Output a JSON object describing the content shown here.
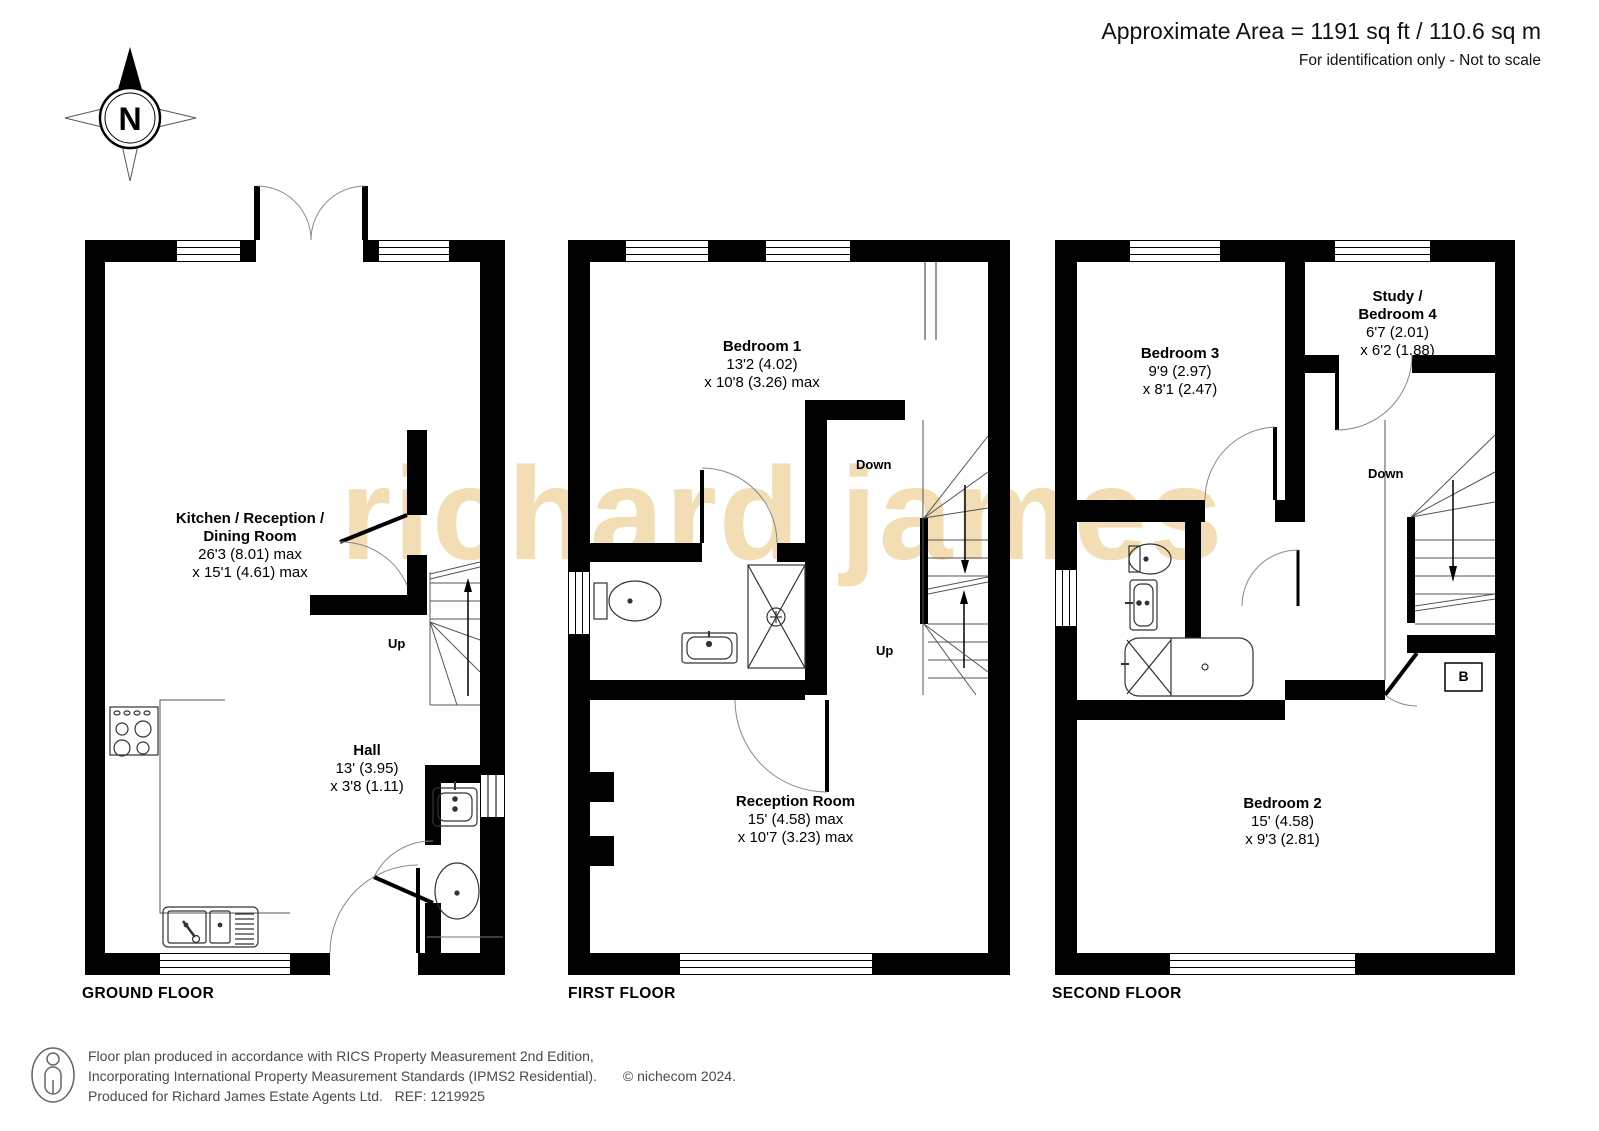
{
  "header": {
    "area": "Approximate Area = 1191 sq ft / 110.6 sq m",
    "disclaimer": "For identification only - Not to scale"
  },
  "compass": {
    "label": "N"
  },
  "watermark": {
    "text": "richard james",
    "color": "#f2ddb4"
  },
  "floors": [
    {
      "name": "GROUND FLOOR",
      "rooms": [
        {
          "id": "kitchen",
          "lines": [
            "Kitchen / Reception /",
            "Dining Room"
          ],
          "dims": [
            "26'3 (8.01) max",
            "x 15'1 (4.61) max"
          ]
        },
        {
          "id": "hall",
          "lines": [
            "Hall"
          ],
          "dims": [
            "13' (3.95)",
            "x 3'8 (1.11)"
          ]
        }
      ],
      "stair_labels": [
        {
          "text": "Up"
        }
      ]
    },
    {
      "name": "FIRST FLOOR",
      "rooms": [
        {
          "id": "bedroom1",
          "lines": [
            "Bedroom 1"
          ],
          "dims": [
            "13'2 (4.02)",
            "x 10'8 (3.26) max"
          ]
        },
        {
          "id": "reception",
          "lines": [
            "Reception Room"
          ],
          "dims": [
            "15' (4.58) max",
            "x 10'7 (3.23) max"
          ]
        }
      ],
      "stair_labels": [
        {
          "text": "Down"
        },
        {
          "text": "Up"
        }
      ]
    },
    {
      "name": "SECOND FLOOR",
      "rooms": [
        {
          "id": "bedroom3",
          "lines": [
            "Bedroom 3"
          ],
          "dims": [
            "9'9 (2.97)",
            "x 8'1 (2.47)"
          ]
        },
        {
          "id": "study",
          "lines": [
            "Study /",
            "Bedroom 4"
          ],
          "dims": [
            "6'7 (2.01)",
            "x 6'2 (1.88)"
          ]
        },
        {
          "id": "bedroom2",
          "lines": [
            "Bedroom 2"
          ],
          "dims": [
            "15' (4.58)",
            "x 9'3 (2.81)"
          ]
        }
      ],
      "stair_labels": [
        {
          "text": "Down"
        }
      ],
      "boiler_label": "B"
    }
  ],
  "footer": {
    "lines": [
      "Floor plan produced in accordance with RICS Property Measurement 2nd Edition,",
      "Incorporating International Property Measurement Standards (IPMS2 Residential).",
      "Produced for Richard James Estate Agents Ltd.   REF: 1219925"
    ],
    "copyright": "© nichecom 2024."
  }
}
